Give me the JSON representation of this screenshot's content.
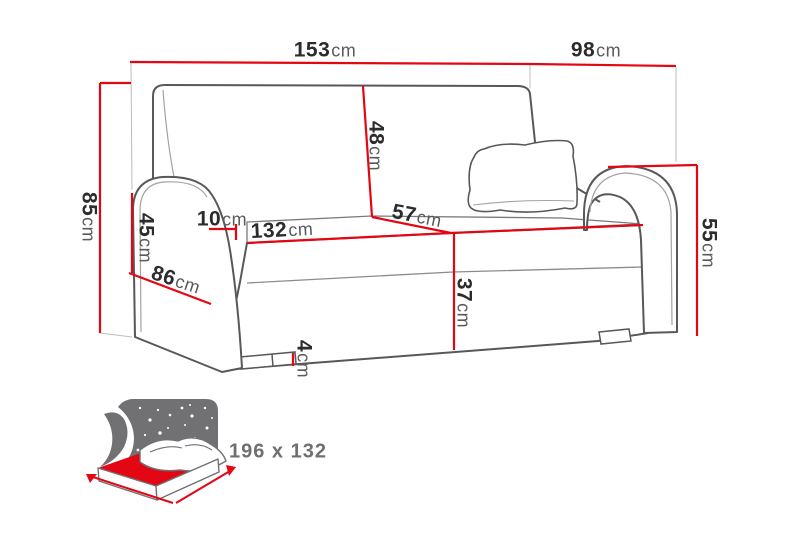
{
  "colors": {
    "dimension_red": "#e30613",
    "outline_dark": "#58585a",
    "outline_light": "#a3a3a5",
    "construction_gray": "#bcbcbe",
    "label_number": "#2c2c2e",
    "label_unit": "#5a5a5c",
    "icon_gray": "#717173"
  },
  "diagram": {
    "unit": "cm",
    "dimensions": {
      "total_width": {
        "value": "153",
        "unit": "cm"
      },
      "total_depth": {
        "value": "98",
        "unit": "cm"
      },
      "total_height": {
        "value": "85",
        "unit": "cm"
      },
      "backrest_height": {
        "value": "48",
        "unit": "cm"
      },
      "armrest_height": {
        "value": "45",
        "unit": "cm"
      },
      "armrest_width": {
        "value": "10",
        "unit": "cm"
      },
      "seat_width": {
        "value": "132",
        "unit": "cm"
      },
      "seat_depth": {
        "value": "57",
        "unit": "cm"
      },
      "seat_height": {
        "value": "37",
        "unit": "cm"
      },
      "leg_height": {
        "value": "4",
        "unit": "cm"
      },
      "arm_front_height": {
        "value": "55",
        "unit": "cm"
      },
      "side_depth": {
        "value": "86",
        "unit": "cm"
      }
    },
    "bed_function": {
      "sleeping_area": "196 x 132"
    }
  }
}
